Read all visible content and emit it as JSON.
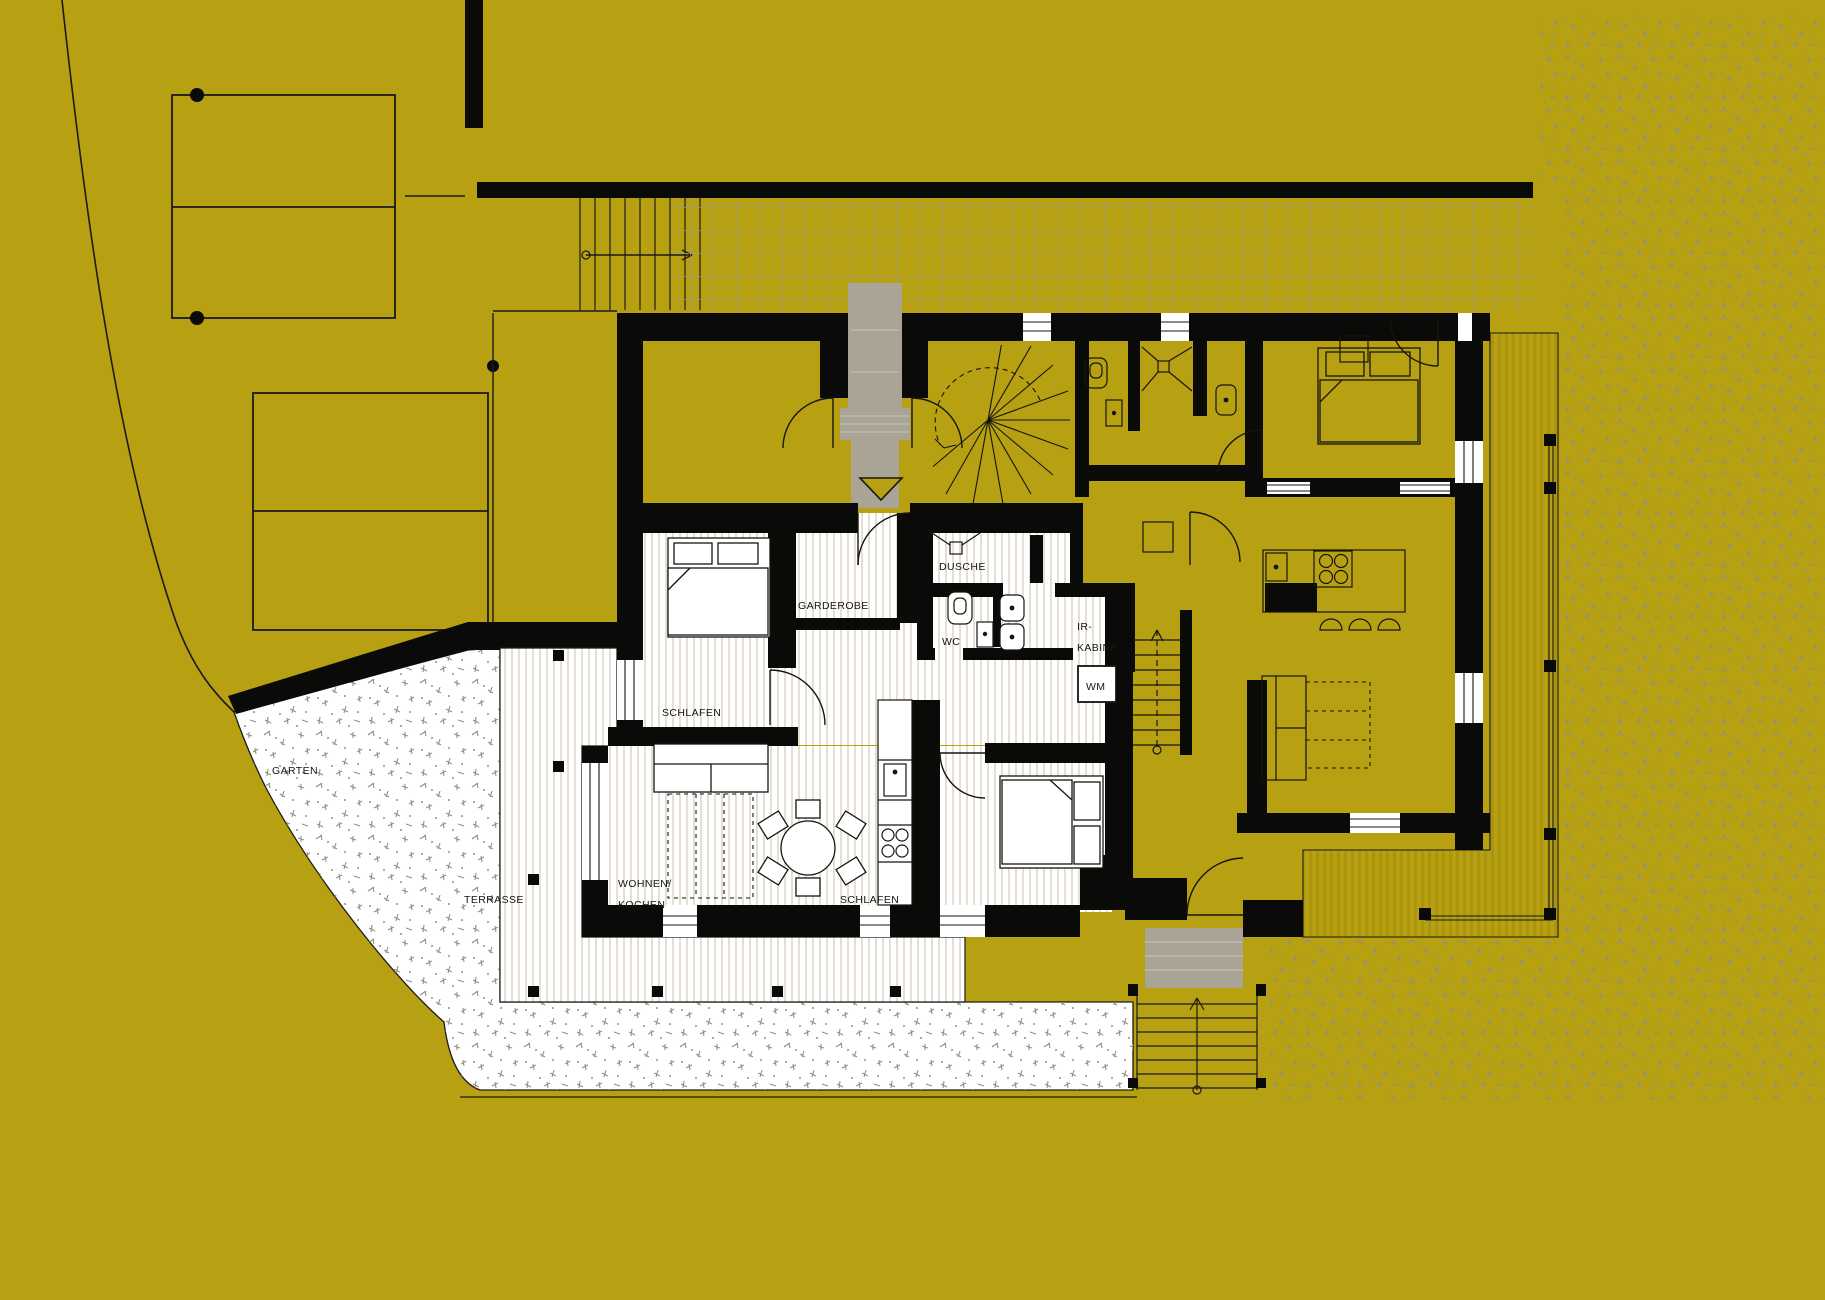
{
  "site": {
    "garten_label": "GARTEN",
    "terrasse_label": "TERRASSE"
  },
  "apartment": {
    "schlafen_top": "SCHLAFEN",
    "garderobe": "GARDEROBE",
    "dusche": "DUSCHE",
    "wc": "WC",
    "ir_kabine_line1": "IR-",
    "ir_kabine_line2": "KABINE",
    "wm": "WM",
    "wohnen_kochen_line1": "WOHNEN/",
    "wohnen_kochen_line2": "KOCHEN",
    "schlafen_bottom": "SCHLAFEN"
  },
  "colors": {
    "background_olive": "#b7a011",
    "wall_black": "#0a0a08",
    "highlight_floor_white": "#ffffff",
    "floor_stripe": "#d8d0c1",
    "entry_path_gray": "#a9a496",
    "courtyard_grid_line": "#9d9d94",
    "grass_mark_gray": "#90907e",
    "deck_stripe": "#aa950c"
  }
}
